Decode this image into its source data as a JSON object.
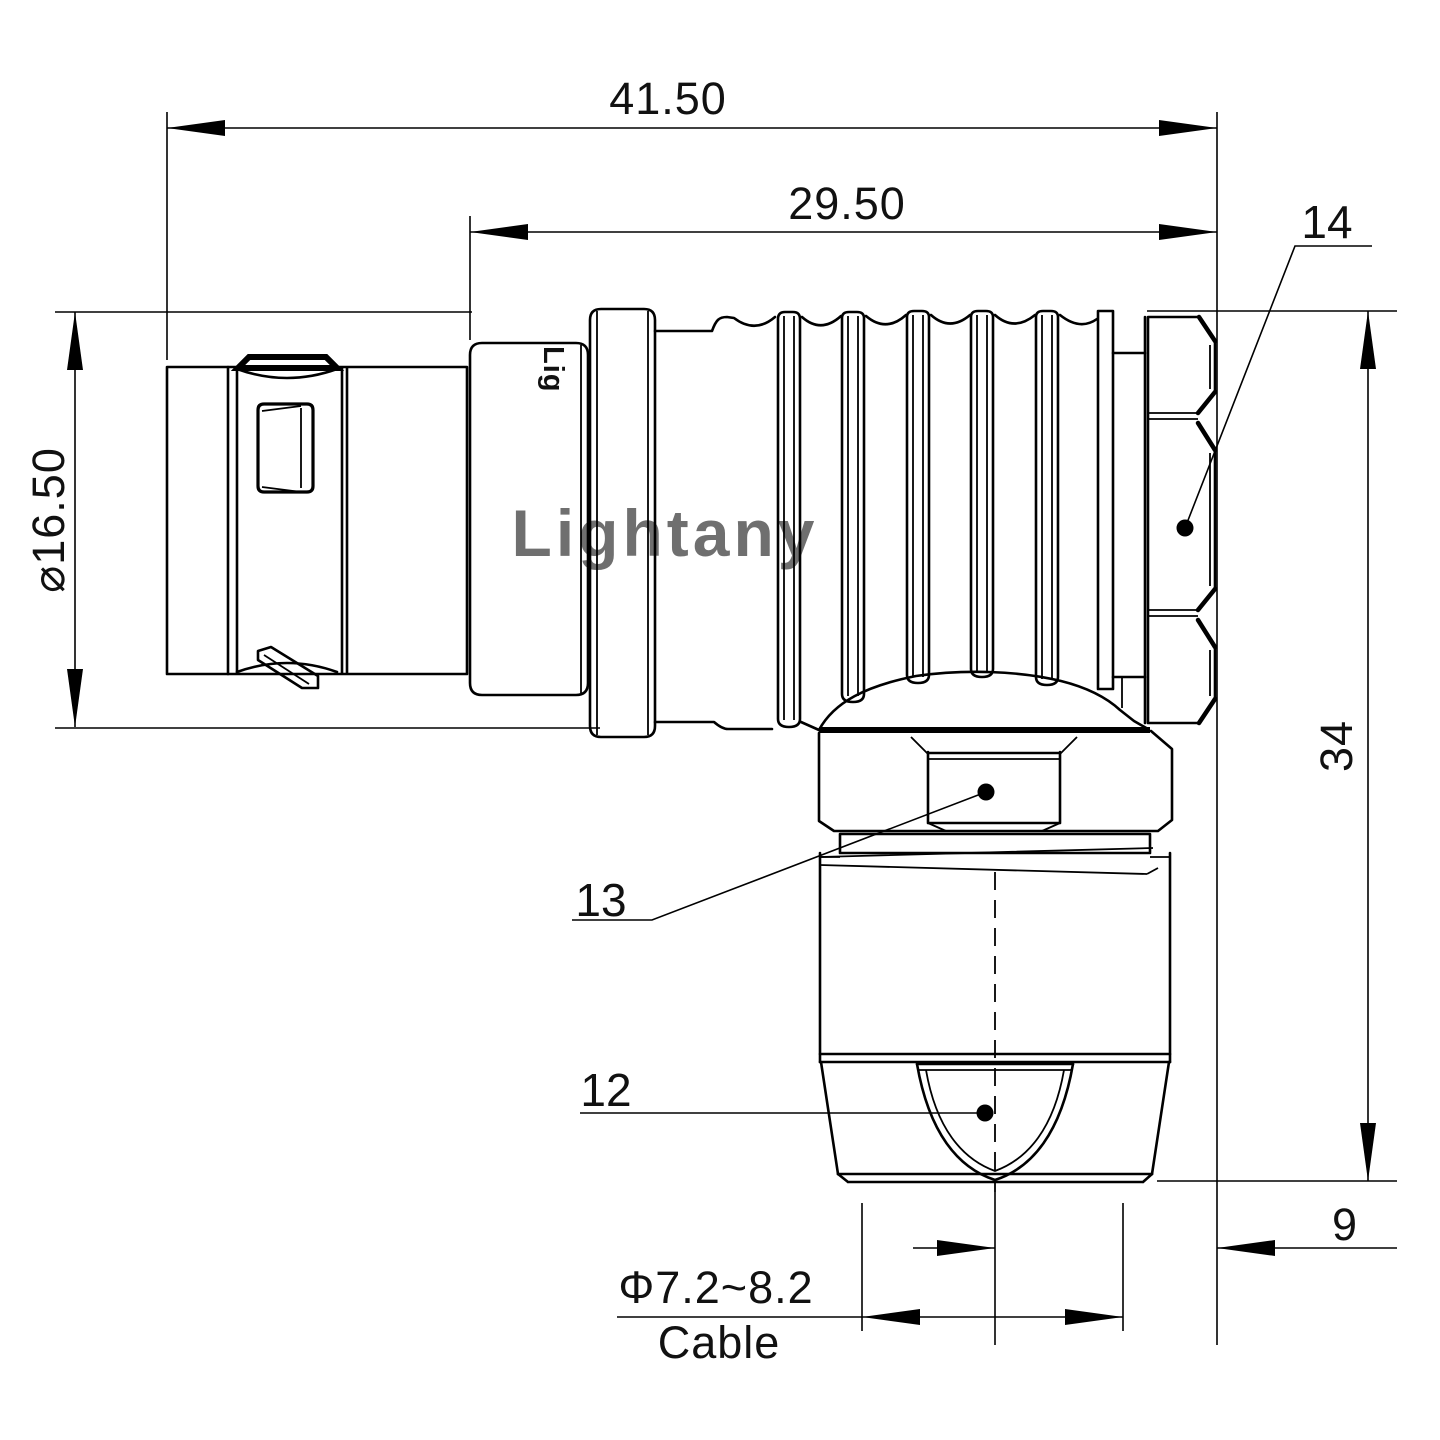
{
  "title": "Right-angle push-pull connector engineering drawing",
  "watermark": "Lightany",
  "body_marking": "Lig",
  "dims": {
    "overall_length": "41.50",
    "rear_length": "29.50",
    "front_diameter": "⌀16.50",
    "overall_height": "34",
    "rear_offset": "9",
    "cable_diameter": "Φ7.2~8.2",
    "cable_label": "Cable"
  },
  "part_labels": {
    "back_nut": "14",
    "coupling_nut": "13",
    "cable_clamp": "12"
  },
  "colors": {
    "line": "#000000",
    "background": "#ffffff",
    "watermark": "#f1c3c3"
  }
}
